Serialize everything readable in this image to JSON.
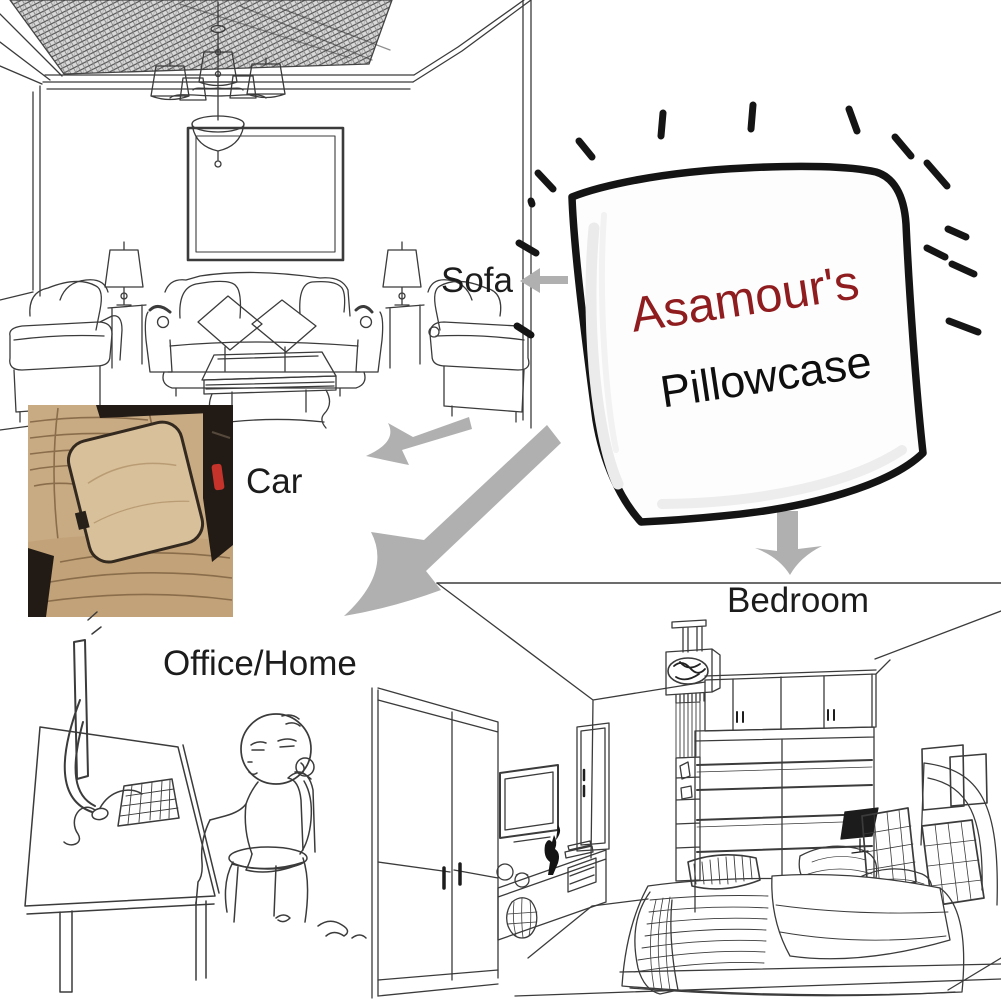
{
  "canvas": {
    "width": 1001,
    "height": 1001,
    "background": "#ffffff"
  },
  "pillow": {
    "brand": "Asamour's",
    "product": "Pillowcase",
    "brand_color": "#8f1c1e",
    "product_color": "#0e0e0e",
    "outline_color": "#141414",
    "fill": "#fdfdfd"
  },
  "labels": {
    "color": "#1c1c1c",
    "sofa": "Sofa",
    "car": "Car",
    "office": "Office/Home",
    "bedroom": "Bedroom"
  },
  "arrows": {
    "color": "#b0b0b0",
    "targets": [
      "sofa",
      "car",
      "office",
      "bedroom"
    ]
  },
  "car_photo": {
    "seat": "#c8ab83",
    "seat_lower": "#c2a278",
    "cushion": "#d8c09b",
    "shadow": "#221b15",
    "stitch": "#8a6d4b",
    "buckle_red": "#c5332b"
  },
  "line_art": {
    "stroke": "#3b3b3b",
    "sparkle": "#151515"
  }
}
